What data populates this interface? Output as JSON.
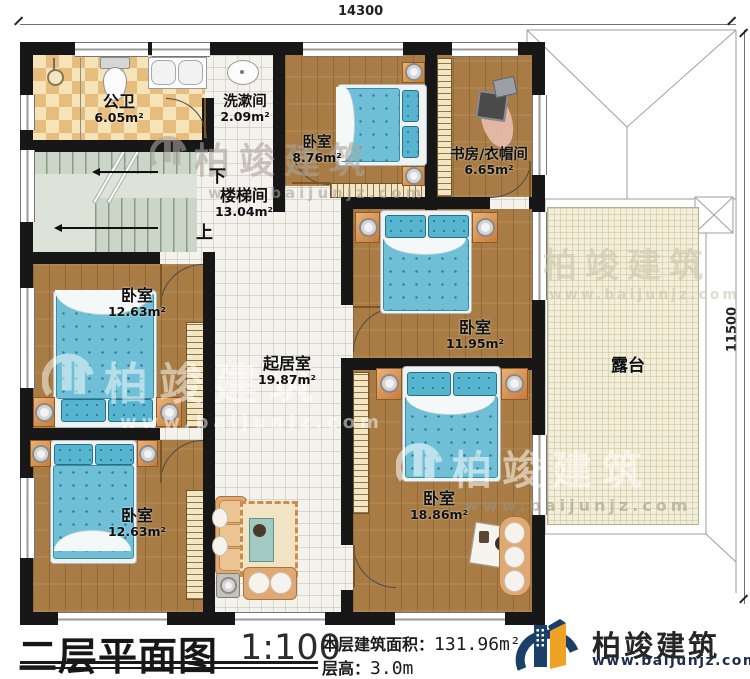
{
  "plan": {
    "dim_top": "14300",
    "dim_right": "11500",
    "stair": {
      "down": "下",
      "up": "上"
    },
    "rooms": [
      {
        "name": "公卫",
        "area": "6.05m²"
      },
      {
        "name": "洗漱间",
        "area": "2.09m²"
      },
      {
        "name": "卧室",
        "area": "8.76m²"
      },
      {
        "name": "书房/衣帽间",
        "area": "6.65m²"
      },
      {
        "name": "楼梯间",
        "area": "13.04m²"
      },
      {
        "name": "卧室",
        "area": "12.63m²"
      },
      {
        "name": "起居室",
        "area": "19.87m²"
      },
      {
        "name": "卧室",
        "area": "11.95m²"
      },
      {
        "name": "卧室",
        "area": "12.63m²"
      },
      {
        "name": "卧室",
        "area": "18.86m²"
      },
      {
        "name": "露台",
        "area": ""
      }
    ]
  },
  "titlebar": {
    "title": "二层平面图",
    "scale": "1:100",
    "area_label": "本层建筑面积：",
    "area_value": "131.96m²",
    "floor_height_label": "层高：",
    "floor_height_value": "3.0m"
  },
  "brand": {
    "name": "柏竣建筑",
    "url": "www.baijunjz.com"
  },
  "watermark": {
    "name": "柏竣建筑",
    "url": "www.baijunjz.com"
  },
  "colors": {
    "wall": "#171717",
    "wood": "#a87c44",
    "mattress": "#6fc0d6",
    "terrace": "#f3eedb",
    "brand_orange": "#f0a224",
    "brand_navy": "#1c3f68"
  }
}
